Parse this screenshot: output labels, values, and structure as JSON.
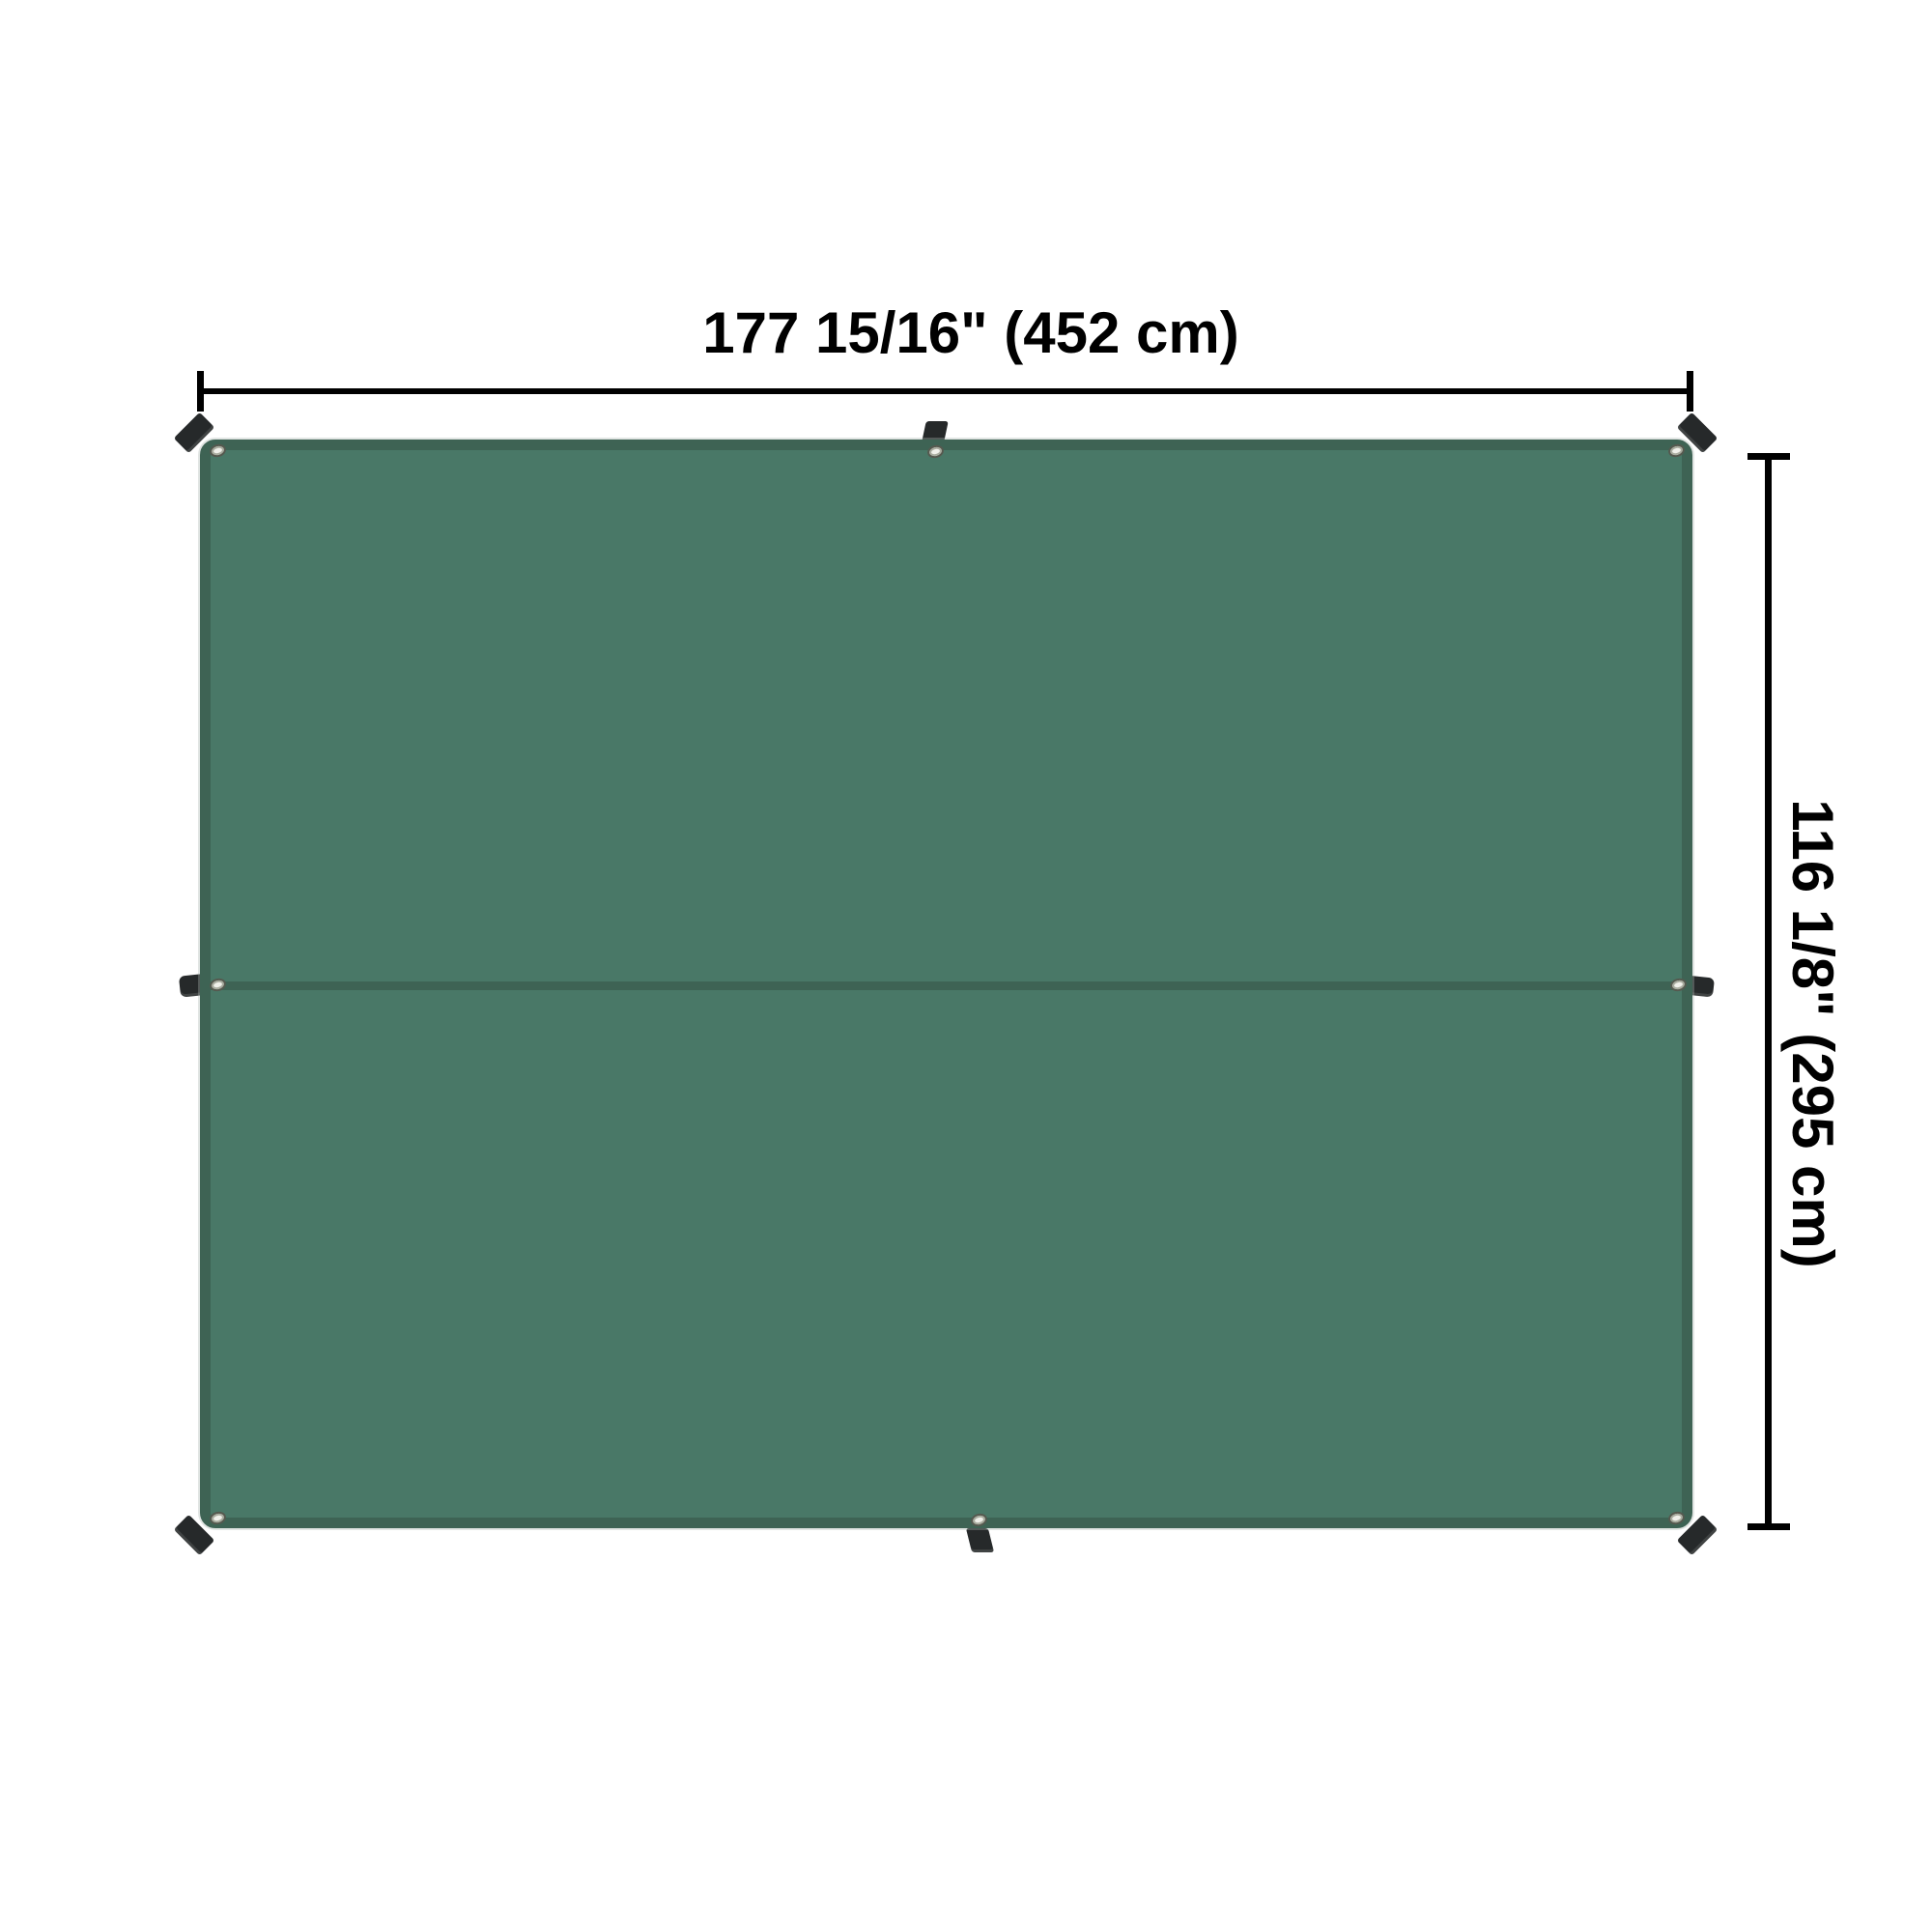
{
  "dimensions": {
    "width_label": "177 15/16\" (452 cm)",
    "height_label": "116 1/8\" (295 cm)"
  },
  "object": {
    "type": "tarp-top-view",
    "grommet_count": 8,
    "tie_tab_count": 8,
    "panel_count": 2
  },
  "colors": {
    "background": "#ffffff",
    "tarp_fill": "#497867",
    "tarp_edge": "#3e6354",
    "tab": "#26292a",
    "grommet_ring": "#a9ac9f",
    "grommet_face": "#f0f0ea",
    "dimension_line": "#000000",
    "label_text": "#000000"
  }
}
